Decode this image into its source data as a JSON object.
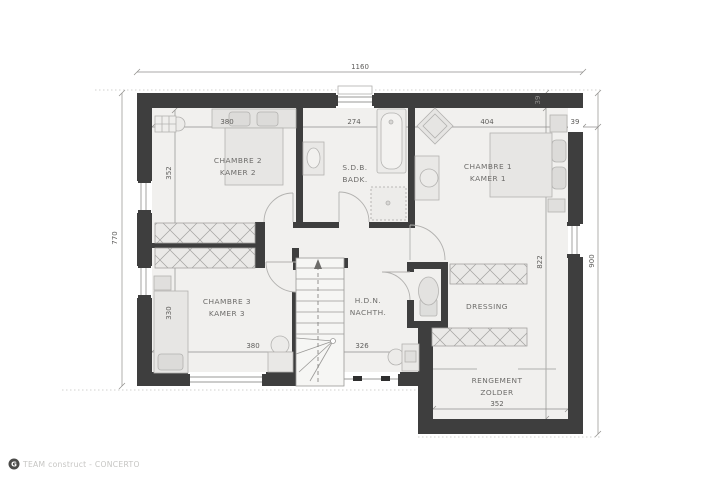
{
  "plan": {
    "brand": {
      "logo_glyph": "G",
      "text": "TEAM construct - CONCERTO"
    },
    "overall_dims": {
      "top": "1160",
      "left": "770",
      "right": "900"
    },
    "wall_dims": {
      "top_thickness": "39",
      "right_thickness": "39"
    },
    "rooms": {
      "chambre2": {
        "fr": "CHAMBRE 2",
        "nl": "KAMER 2",
        "width": "380",
        "depth": "352"
      },
      "sdb": {
        "fr": "S.D.B.",
        "nl": "BADK.",
        "width": "274"
      },
      "chambre1": {
        "fr": "CHAMBRE 1",
        "nl": "KAMER 1",
        "width": "404"
      },
      "chambre3": {
        "fr": "CHAMBRE 3",
        "nl": "KAMER 3",
        "width": "380",
        "depth": "330"
      },
      "hall": {
        "fr": "H.D.N.",
        "nl": "NACHTH.",
        "width": "326"
      },
      "dressing": {
        "label": "DRESSING",
        "depth": "822"
      },
      "zolder": {
        "fr": "RENGEMENT",
        "nl": "ZOLDER",
        "width": "352"
      }
    },
    "colors": {
      "wall": "#3e3e3e",
      "floor": "#f1f0ee",
      "furniture_fill": "#e4e3e1",
      "furniture_stroke": "#b3b2b0",
      "dim_line": "#8f8e8c",
      "label": "#6d6c6a"
    }
  }
}
